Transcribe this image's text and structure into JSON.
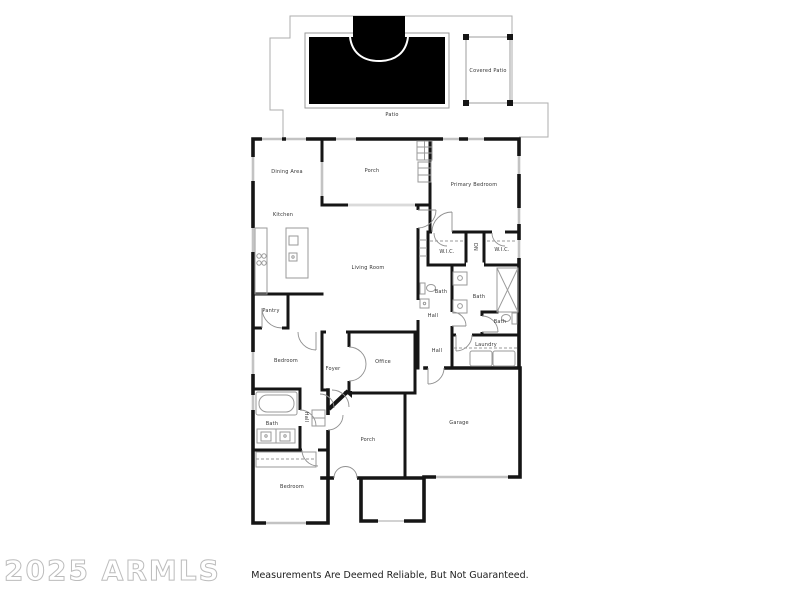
{
  "watermark": "2025 ARMLS",
  "disclaimer": "Measurements Are Deemed Reliable, But Not Guaranteed.",
  "colors": {
    "wall": "#151515",
    "window": "#c3c3c3",
    "outline": "#adadad",
    "fixture": "#9a9a9a",
    "door_arc": "#8f8f8f",
    "pool": "#000000",
    "label_text": "#333333"
  },
  "labels": [
    {
      "text": "Covered Patio",
      "x": 488,
      "y": 71,
      "vertical": false
    },
    {
      "text": "Patio",
      "x": 392,
      "y": 115,
      "vertical": false
    },
    {
      "text": "Dining Area",
      "x": 287,
      "y": 172,
      "vertical": false
    },
    {
      "text": "Porch",
      "x": 372,
      "y": 171,
      "vertical": false
    },
    {
      "text": "Primary Bedroom",
      "x": 474,
      "y": 185,
      "vertical": false
    },
    {
      "text": "Kitchen",
      "x": 283,
      "y": 215,
      "vertical": false
    },
    {
      "text": "Living Room",
      "x": 368,
      "y": 268,
      "vertical": false
    },
    {
      "text": "W.I.C.",
      "x": 447,
      "y": 252,
      "vertical": false
    },
    {
      "text": "DN",
      "x": 475,
      "y": 247,
      "vertical": true
    },
    {
      "text": "W.I.C.",
      "x": 502,
      "y": 250,
      "vertical": false
    },
    {
      "text": "Bath",
      "x": 441,
      "y": 292,
      "vertical": false
    },
    {
      "text": "Bath",
      "x": 479,
      "y": 297,
      "vertical": false
    },
    {
      "text": "Hall",
      "x": 433,
      "y": 316,
      "vertical": false
    },
    {
      "text": "Bath",
      "x": 500,
      "y": 322,
      "vertical": false
    },
    {
      "text": "Laundry",
      "x": 486,
      "y": 345,
      "vertical": false
    },
    {
      "text": "Hall",
      "x": 437,
      "y": 351,
      "vertical": false
    },
    {
      "text": "Pantry",
      "x": 271,
      "y": 311,
      "vertical": false
    },
    {
      "text": "Bedroom",
      "x": 286,
      "y": 361,
      "vertical": false
    },
    {
      "text": "Foyer",
      "x": 333,
      "y": 369,
      "vertical": false
    },
    {
      "text": "Office",
      "x": 383,
      "y": 362,
      "vertical": false
    },
    {
      "text": "Bath",
      "x": 272,
      "y": 424,
      "vertical": false
    },
    {
      "text": "Hall",
      "x": 306,
      "y": 417,
      "vertical": true
    },
    {
      "text": "Porch",
      "x": 368,
      "y": 440,
      "vertical": false
    },
    {
      "text": "Garage",
      "x": 459,
      "y": 423,
      "vertical": false
    },
    {
      "text": "Bedroom",
      "x": 292,
      "y": 487,
      "vertical": false
    }
  ]
}
